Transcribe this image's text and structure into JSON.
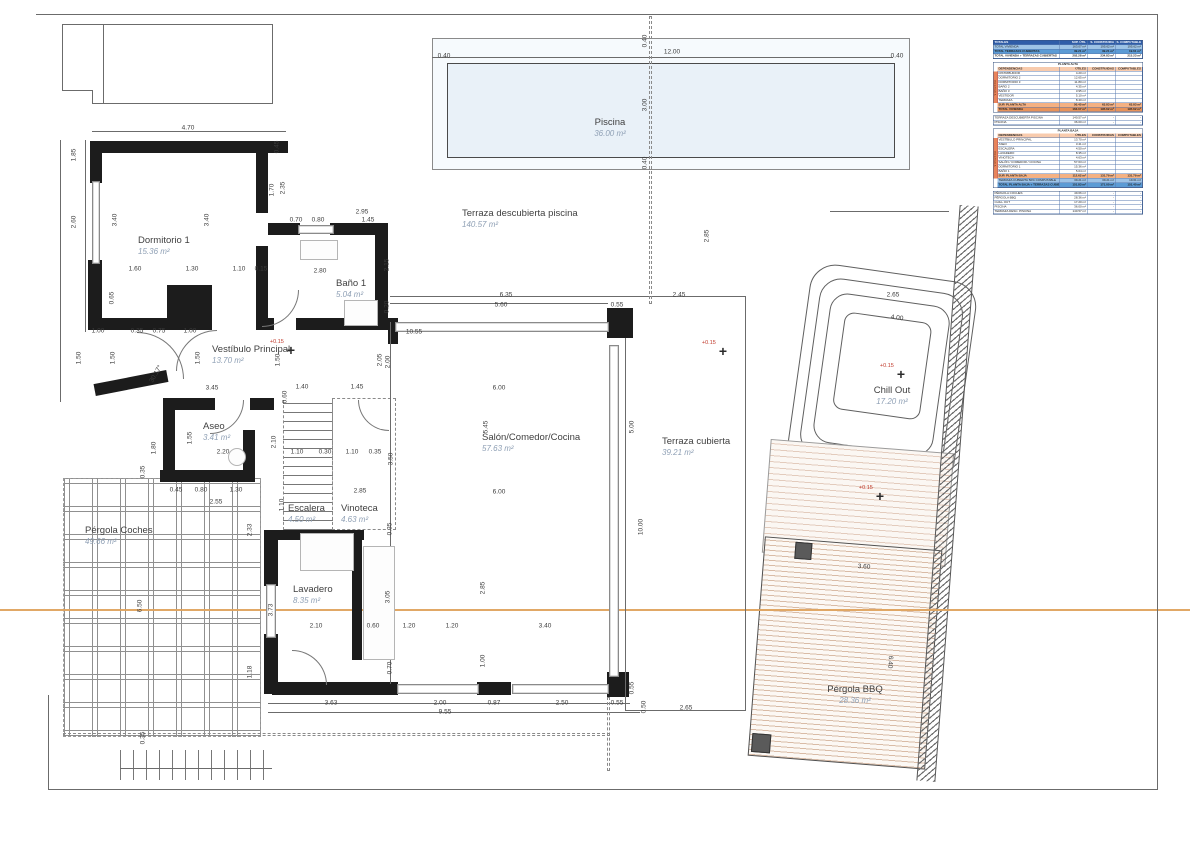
{
  "plan": {
    "rooms": [
      {
        "n": "Piscina",
        "a": "36.00 m²",
        "x": 610,
        "y": 118,
        "c": true
      },
      {
        "n": "Terraza descubierta piscina",
        "a": "140.57 m²",
        "x": 462,
        "y": 209
      },
      {
        "n": "Dormitorio 1",
        "a": "15.36 m²",
        "x": 138,
        "y": 236
      },
      {
        "n": "Baño 1",
        "a": "5.04 m²",
        "x": 336,
        "y": 279
      },
      {
        "n": "Vestíbulo Principal",
        "a": "13.70 m²",
        "x": 212,
        "y": 345
      },
      {
        "n": "Aseo",
        "a": "3.41 m²",
        "x": 203,
        "y": 422
      },
      {
        "n": "Escalera",
        "a": "4.50 m²",
        "x": 288,
        "y": 504
      },
      {
        "n": "Vinoteca",
        "a": "4.63 m²",
        "x": 341,
        "y": 504
      },
      {
        "n": "Salón/Comedor/Cocina",
        "a": "57.63 m²",
        "x": 482,
        "y": 433
      },
      {
        "n": "Lavadero",
        "a": "8.35 m²",
        "x": 293,
        "y": 585
      },
      {
        "n": "Terraza cubierta",
        "a": "39.21 m²",
        "x": 662,
        "y": 437
      },
      {
        "n": "Pérgola Coches",
        "a": "49.66 m²",
        "x": 85,
        "y": 526
      },
      {
        "n": "Chill Out",
        "a": "17.20 m²",
        "x": 892,
        "y": 386,
        "c": true
      },
      {
        "n": "Pérgola BBQ",
        "a": "28.36 m²",
        "x": 855,
        "y": 685,
        "c": true
      }
    ],
    "markers": [
      {
        "label": "+0.15",
        "x": 291,
        "y": 350
      },
      {
        "label": "+0.15",
        "x": 723,
        "y": 351
      },
      {
        "label": "+0.15",
        "x": 901,
        "y": 374
      },
      {
        "label": "+0.15",
        "x": 880,
        "y": 496
      }
    ],
    "dimensions": [
      {
        "t": "4.70",
        "x": 188,
        "y": 128
      },
      {
        "t": "1.85",
        "x": 74,
        "y": 155,
        "o": "v"
      },
      {
        "t": "2.60",
        "x": 74,
        "y": 222,
        "o": "v"
      },
      {
        "t": "3.40",
        "x": 115,
        "y": 220,
        "o": "v"
      },
      {
        "t": "3.40",
        "x": 207,
        "y": 220,
        "o": "v"
      },
      {
        "t": "0.65",
        "x": 112,
        "y": 298,
        "o": "v"
      },
      {
        "t": "0.45",
        "x": 277,
        "y": 147,
        "o": "v"
      },
      {
        "t": "1.70",
        "x": 272,
        "y": 190,
        "o": "v"
      },
      {
        "t": "2.35",
        "x": 283,
        "y": 188,
        "o": "v"
      },
      {
        "t": "2.95",
        "x": 362,
        "y": 212
      },
      {
        "t": "0.70",
        "x": 296,
        "y": 220
      },
      {
        "t": "0.80",
        "x": 318,
        "y": 220
      },
      {
        "t": "1.45",
        "x": 368,
        "y": 220
      },
      {
        "t": "1.60",
        "x": 135,
        "y": 269
      },
      {
        "t": "1.30",
        "x": 192,
        "y": 269
      },
      {
        "t": "1.10",
        "x": 239,
        "y": 269
      },
      {
        "t": "0.15",
        "x": 261,
        "y": 269
      },
      {
        "t": "2.80",
        "x": 320,
        "y": 271
      },
      {
        "t": "2.15",
        "x": 387,
        "y": 265,
        "o": "v"
      },
      {
        "t": "0.20",
        "x": 387,
        "y": 307,
        "o": "v"
      },
      {
        "t": "1.00",
        "x": 98,
        "y": 331
      },
      {
        "t": "0.35",
        "x": 137,
        "y": 331
      },
      {
        "t": "0.75",
        "x": 159,
        "y": 331
      },
      {
        "t": "1.00",
        "x": 190,
        "y": 331
      },
      {
        "t": "1.50",
        "x": 79,
        "y": 358,
        "o": "v"
      },
      {
        "t": "1.50",
        "x": 113,
        "y": 358,
        "o": "v"
      },
      {
        "t": "1.50",
        "x": 198,
        "y": 358,
        "o": "v"
      },
      {
        "t": "1.50",
        "x": 278,
        "y": 360,
        "o": "v"
      },
      {
        "t": "2.05",
        "x": 380,
        "y": 360,
        "o": "v"
      },
      {
        "t": "30.17°",
        "x": 156,
        "y": 374,
        "r": -60
      },
      {
        "t": "3.45",
        "x": 212,
        "y": 388
      },
      {
        "t": "1.40",
        "x": 302,
        "y": 387
      },
      {
        "t": "1.45",
        "x": 357,
        "y": 387
      },
      {
        "t": "0.60",
        "x": 285,
        "y": 397,
        "o": "v"
      },
      {
        "t": "1.55",
        "x": 190,
        "y": 438,
        "o": "v"
      },
      {
        "t": "1.80",
        "x": 154,
        "y": 448,
        "o": "v"
      },
      {
        "t": "2.20",
        "x": 223,
        "y": 452
      },
      {
        "t": "2.10",
        "x": 274,
        "y": 442,
        "o": "v"
      },
      {
        "t": "1.10",
        "x": 297,
        "y": 452
      },
      {
        "t": "0.30",
        "x": 325,
        "y": 452
      },
      {
        "t": "1.10",
        "x": 352,
        "y": 452
      },
      {
        "t": "0.35",
        "x": 375,
        "y": 452
      },
      {
        "t": "0.45",
        "x": 176,
        "y": 490
      },
      {
        "t": "0.80",
        "x": 201,
        "y": 490
      },
      {
        "t": "1.30",
        "x": 236,
        "y": 490
      },
      {
        "t": "2.55",
        "x": 216,
        "y": 502
      },
      {
        "t": "2.85",
        "x": 360,
        "y": 491
      },
      {
        "t": "1.10",
        "x": 282,
        "y": 505,
        "o": "v"
      },
      {
        "t": "0.35",
        "x": 390,
        "y": 529,
        "o": "v"
      },
      {
        "t": "6.35",
        "x": 506,
        "y": 295
      },
      {
        "t": "5.60",
        "x": 501,
        "y": 305
      },
      {
        "t": "0.55",
        "x": 617,
        "y": 305
      },
      {
        "t": "2.45",
        "x": 679,
        "y": 295
      },
      {
        "t": "2.65",
        "x": 893,
        "y": 295
      },
      {
        "t": "10.55",
        "x": 414,
        "y": 332
      },
      {
        "t": "2.00",
        "x": 388,
        "y": 362,
        "o": "v"
      },
      {
        "t": "2.85",
        "x": 707,
        "y": 236,
        "o": "v"
      },
      {
        "t": "6.00",
        "x": 499,
        "y": 388
      },
      {
        "t": "5.45",
        "x": 486,
        "y": 427,
        "o": "v"
      },
      {
        "t": "3.50",
        "x": 391,
        "y": 459,
        "o": "v"
      },
      {
        "t": "6.00",
        "x": 499,
        "y": 492
      },
      {
        "t": "5.00",
        "x": 632,
        "y": 427,
        "o": "v"
      },
      {
        "t": "10.00",
        "x": 641,
        "y": 527,
        "o": "v"
      },
      {
        "t": "2.85",
        "x": 483,
        "y": 588,
        "o": "v"
      },
      {
        "t": "3.05",
        "x": 388,
        "y": 597,
        "o": "v"
      },
      {
        "t": "3.73",
        "x": 271,
        "y": 610,
        "o": "v"
      },
      {
        "t": "2.10",
        "x": 316,
        "y": 626
      },
      {
        "t": "0.60",
        "x": 373,
        "y": 626
      },
      {
        "t": "1.20",
        "x": 409,
        "y": 626
      },
      {
        "t": "1.20",
        "x": 452,
        "y": 626
      },
      {
        "t": "3.40",
        "x": 545,
        "y": 626
      },
      {
        "t": "1.00",
        "x": 483,
        "y": 661,
        "o": "v"
      },
      {
        "t": "0.70",
        "x": 390,
        "y": 668,
        "o": "v"
      },
      {
        "t": "3.63",
        "x": 331,
        "y": 703
      },
      {
        "t": "2.00",
        "x": 440,
        "y": 703
      },
      {
        "t": "0.87",
        "x": 494,
        "y": 703
      },
      {
        "t": "2.50",
        "x": 562,
        "y": 703
      },
      {
        "t": "0.55",
        "x": 617,
        "y": 703
      },
      {
        "t": "9.55",
        "x": 445,
        "y": 712
      },
      {
        "t": "0.55",
        "x": 632,
        "y": 688,
        "o": "v"
      },
      {
        "t": "0.50",
        "x": 644,
        "y": 707,
        "o": "v"
      },
      {
        "t": "2.65",
        "x": 686,
        "y": 708
      },
      {
        "t": "12.00",
        "x": 672,
        "y": 52
      },
      {
        "t": "0.40",
        "x": 444,
        "y": 56
      },
      {
        "t": "0.40",
        "x": 897,
        "y": 56
      },
      {
        "t": "3.00",
        "x": 645,
        "y": 105,
        "o": "v"
      },
      {
        "t": "0.40",
        "x": 645,
        "y": 41,
        "o": "v"
      },
      {
        "t": "0.40",
        "x": 645,
        "y": 163,
        "o": "v"
      },
      {
        "t": "6.50",
        "x": 140,
        "y": 606,
        "o": "v"
      },
      {
        "t": "2.33",
        "x": 250,
        "y": 530,
        "o": "v"
      },
      {
        "t": "1.18",
        "x": 250,
        "y": 672,
        "o": "v"
      },
      {
        "t": "0.35",
        "x": 143,
        "y": 472,
        "o": "v"
      },
      {
        "t": "0.35",
        "x": 143,
        "y": 738,
        "o": "v"
      },
      {
        "t": "4.00",
        "x": 897,
        "y": 318,
        "r": 8
      },
      {
        "t": "3.60",
        "x": 864,
        "y": 567,
        "r": 4
      },
      {
        "t": "6.40",
        "x": 890,
        "y": 662,
        "r": 94
      }
    ]
  },
  "table": {
    "blocks": [
      {
        "band": "",
        "rows": [
          {
            "s": "hdr",
            "c": [
              "TOTALES",
              "SUP. ÚTIL",
              "S. CONSTRUIDA",
              "S. COMPUTABLE"
            ]
          },
          {
            "s": "blue",
            "c": [
              "TOTAL VIVIENDA",
              "163.07 m²",
              "195.62 m²",
              "195.62 m²"
            ]
          },
          {
            "s": "blue2",
            "c": [
              "TOTAL TERRAZAS CUBIERTAS",
              "39.21 m²",
              "39.21 m²",
              "19.61 m²"
            ]
          },
          {
            "s": "bold",
            "c": [
              "TOTAL VIVIENDA + TERRAZAS CUBIERTAS",
              "202.28 m²",
              "234.83 m²",
              "215.23 m²"
            ]
          }
        ]
      },
      {
        "band": "VIVIENDA",
        "rows": [
          {
            "s": "title",
            "c": [
              "PLANTA ALTA",
              "",
              "",
              ""
            ]
          },
          {
            "s": "shdr",
            "c": [
              "DEPENDENCIAS",
              "ÚTILES",
              "CONSTRUIDAS",
              "COMPUTABLES"
            ]
          },
          {
            "s": "plain",
            "c": [
              "DISTRIBUIDOR",
              "4.20 m²",
              "",
              ""
            ]
          },
          {
            "s": "plain",
            "c": [
              "DORMITORIO 2",
              "12.65 m²",
              "",
              ""
            ]
          },
          {
            "s": "plain",
            "c": [
              "DORMITORIO 3",
              "11.80 m²",
              "",
              ""
            ]
          },
          {
            "s": "plain",
            "c": [
              "BAÑO 2",
              "4.35 m²",
              "",
              ""
            ]
          },
          {
            "s": "plain",
            "c": [
              "BAÑO 3",
              "3.95 m²",
              "",
              ""
            ]
          },
          {
            "s": "plain",
            "c": [
              "VESTIDOR",
              "5.10 m²",
              "",
              ""
            ]
          },
          {
            "s": "plain",
            "c": [
              "TERRAZA",
              "8.40 m²",
              "",
              ""
            ]
          },
          {
            "s": "orange",
            "c": [
              "SUP. PLANTA ALTA",
              "50.45 m²",
              "63.83 m²",
              "63.83 m²"
            ]
          },
          {
            "s": "orange2",
            "c": [
              "TOTAL VIVIENDA",
              "163.07 m²",
              "195.62 m²",
              "195.62 m²"
            ]
          }
        ]
      },
      {
        "band": "",
        "rows": [
          {
            "s": "plain",
            "c": [
              "TERRAZA DESCUBIERTA PISCINA",
              "140.57 m²",
              "-",
              "-"
            ]
          },
          {
            "s": "plain",
            "c": [
              "PISCINA",
              "36.00 m²",
              "-",
              "-"
            ]
          }
        ]
      },
      {
        "band": "VIVIENDA",
        "rows": [
          {
            "s": "title",
            "c": [
              "PLANTA BAJA",
              "",
              "",
              ""
            ]
          },
          {
            "s": "shdr",
            "c": [
              "DEPENDENCIAS",
              "ÚTILES",
              "CONSTRUIDAS",
              "COMPUTABLES"
            ]
          },
          {
            "s": "plain",
            "c": [
              "VESTÍBULO PRINCIPAL",
              "13.70 m²",
              "",
              ""
            ]
          },
          {
            "s": "plain",
            "c": [
              "ASEO",
              "3.41 m²",
              "",
              ""
            ]
          },
          {
            "s": "plain",
            "c": [
              "ESCALERA",
              "4.50 m²",
              "",
              ""
            ]
          },
          {
            "s": "plain",
            "c": [
              "LAVADERO",
              "8.35 m²",
              "",
              ""
            ]
          },
          {
            "s": "plain",
            "c": [
              "VINOTECA",
              "4.63 m²",
              "",
              ""
            ]
          },
          {
            "s": "plain",
            "c": [
              "SALÓN / COMEDOR / COCINA",
              "57.63 m²",
              "",
              ""
            ]
          },
          {
            "s": "plain",
            "c": [
              "DORMITORIO 1",
              "15.36 m²",
              "",
              ""
            ]
          },
          {
            "s": "plain",
            "c": [
              "BAÑO 1",
              "5.04 m²",
              "",
              ""
            ]
          },
          {
            "s": "orange",
            "c": [
              "SUP. PLANTA BAJA",
              "112.62 m²",
              "131.79 m²",
              "131.79 m²"
            ]
          },
          {
            "s": "blue",
            "c": [
              "TERRAZA CUBIERTA 50% COMPUTABLE",
              "39.21 m²",
              "39.21 m²",
              "19.61 m²"
            ]
          },
          {
            "s": "blue2",
            "c": [
              "TOTAL PLANTA BAJA + TERRAZAS CUBIERTAS",
              "151.83 m²",
              "171.00 m²",
              "151.40 m²"
            ]
          }
        ]
      },
      {
        "band": "",
        "rows": [
          {
            "s": "plain",
            "c": [
              "PÉRGOLA COCHES",
              "49.66 m²",
              "-",
              "-"
            ]
          },
          {
            "s": "plain",
            "c": [
              "PÉRGOLA BBQ",
              "28.36 m²",
              "-",
              "-"
            ]
          },
          {
            "s": "plain",
            "c": [
              "CHILL OUT",
              "17.20 m²",
              "-",
              "-"
            ]
          },
          {
            "s": "plain",
            "c": [
              "PISCINA",
              "36.00 m²",
              "-",
              "-"
            ]
          },
          {
            "s": "plain",
            "c": [
              "TERRAZA DESC. PISCINA",
              "140.57 m²",
              "-",
              "-"
            ]
          }
        ]
      }
    ]
  },
  "colors": {
    "wall": "#1c1c1c",
    "pool_fill": "#e9f1f8",
    "cut_line": "#dfa35e",
    "marker_red": "#c0392b",
    "table_header": "#2f5da8",
    "table_blue": "#9dc3e6",
    "table_orange": "#f4b183"
  }
}
